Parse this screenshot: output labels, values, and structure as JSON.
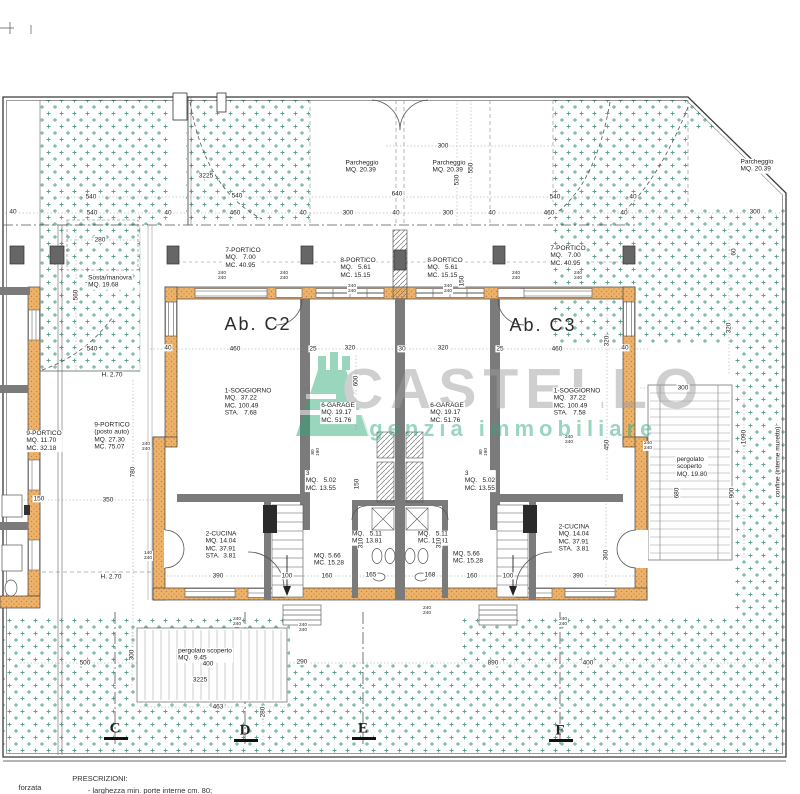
{
  "watermark": {
    "brand": "CASTELLO",
    "tagline": "agenzia immobiliare",
    "brand_color": "#9d9d9d",
    "tagline_color": "#2da879"
  },
  "colors": {
    "stipple_green": "#5aa588",
    "wall_orange": "#edb36b",
    "wall_gray": "#7b7b7b",
    "line_dark": "#3a3a3a"
  },
  "plan": {
    "labels": [
      {
        "n": "room-7-portico-left",
        "k": "room",
        "x": 243,
        "y": 258,
        "t": [
          "7-PORTICO",
          "MQ.   7.00",
          "MC. 40.95"
        ]
      },
      {
        "n": "room-8-portico-left",
        "k": "room",
        "x": 358,
        "y": 268,
        "t": [
          "8-PORTICO",
          "MQ.   5.61",
          "MC. 15.15"
        ]
      },
      {
        "n": "room-8-portico-right",
        "k": "room",
        "x": 445,
        "y": 268,
        "t": [
          "8-PORTICO",
          "MQ.   5.61",
          "MC. 15.15"
        ]
      },
      {
        "n": "room-7-portico-right",
        "k": "room",
        "x": 568,
        "y": 256,
        "t": [
          "7-PORTICO",
          "MQ.   7.00",
          "MC. 40.95"
        ]
      },
      {
        "n": "unit-label-c2",
        "k": "big",
        "x": 258,
        "y": 324,
        "t": [
          "Ab. C2"
        ]
      },
      {
        "n": "unit-label-c3",
        "k": "big",
        "x": 543,
        "y": 325,
        "t": [
          "Ab. C3"
        ]
      },
      {
        "n": "room-soggiorno-left",
        "k": "room",
        "x": 248,
        "y": 402,
        "t": [
          "1-SOGGIORNO",
          "MQ.  37.22",
          "MC. 100.49",
          "STA.   7.68"
        ]
      },
      {
        "n": "room-soggiorno-right",
        "k": "room",
        "x": 577,
        "y": 402,
        "t": [
          "1-SOGGIORNO",
          "MQ.  37.22",
          "MC. 100.49",
          "STA.   7.58"
        ]
      },
      {
        "n": "room-garage-left",
        "k": "room",
        "x": 338,
        "y": 413,
        "t": [
          "6-GARAGE",
          "MQ. 19.17",
          "MC. 51.76"
        ]
      },
      {
        "n": "room-garage-right",
        "k": "room",
        "x": 447,
        "y": 413,
        "t": [
          "6-GARAGE",
          "MQ. 19.17",
          "MC. 51.76"
        ]
      },
      {
        "n": "room-cucina-left",
        "k": "room",
        "x": 221,
        "y": 545,
        "t": [
          "2-CUCINA",
          "MQ. 14.04",
          "MC. 37.91",
          "STA.  3.81"
        ]
      },
      {
        "n": "room-cucina-right",
        "k": "room",
        "x": 574,
        "y": 538,
        "t": [
          "2-CUCINA",
          "MQ. 14.04",
          "MC. 37.91",
          "STA.  3.81"
        ]
      },
      {
        "n": "room-3-left",
        "k": "room",
        "x": 321,
        "y": 481,
        "t": [
          "3",
          "MQ.   5.02",
          "MC. 13.55"
        ]
      },
      {
        "n": "room-3-right",
        "k": "room",
        "x": 480,
        "y": 481,
        "t": [
          "3",
          "MQ.   5.02",
          "MC. 13.55"
        ]
      },
      {
        "n": "room-bath-left",
        "k": "room",
        "x": 367,
        "y": 538,
        "t": [
          "MQ.   5.11",
          "MC. 13.81"
        ]
      },
      {
        "n": "room-bath-right",
        "k": "room",
        "x": 433,
        "y": 538,
        "t": [
          "MQ.   5.11",
          "MC. 13.81"
        ]
      },
      {
        "n": "room-stair-left",
        "k": "room",
        "x": 329,
        "y": 560,
        "t": [
          "MQ. 5.66",
          "MC. 15.28"
        ]
      },
      {
        "n": "room-stair-right",
        "k": "room",
        "x": 468,
        "y": 558,
        "t": [
          "MQ. 5.66",
          "MC. 15.28"
        ]
      },
      {
        "n": "room-9-portico-small",
        "k": "room",
        "x": 44,
        "y": 441,
        "t": [
          "9-PORTICO",
          "MQ. 11.70",
          "MC. 32.18"
        ]
      },
      {
        "n": "room-9-portico-posto",
        "k": "room",
        "x": 112,
        "y": 436,
        "t": [
          "9-PORTICO",
          "(posto auto)",
          "MQ. 27.30",
          "MC. 75.07"
        ]
      },
      {
        "n": "room-sosta-manovra",
        "k": "room",
        "x": 110,
        "y": 282,
        "t": [
          "Sosta/manovra",
          "MQ. 19.68"
        ]
      },
      {
        "n": "room-parcheggio-left",
        "k": "room",
        "x": 362,
        "y": 167,
        "t": [
          "Parcheggio",
          "MQ. 20.39"
        ]
      },
      {
        "n": "room-parcheggio-right",
        "k": "room",
        "x": 449,
        "y": 167,
        "t": [
          "Parcheggio",
          "MQ. 20.39"
        ]
      },
      {
        "n": "room-parcheggio-far",
        "k": "room",
        "x": 757,
        "y": 166,
        "t": [
          "Parcheggio",
          "MQ. 20.39"
        ]
      },
      {
        "n": "room-pergolato-right",
        "k": "room",
        "x": 692,
        "y": 467,
        "t": [
          "pergolato",
          "scoperto",
          "MQ. 19.80"
        ]
      },
      {
        "n": "room-pergolato-bottom",
        "k": "room",
        "x": 205,
        "y": 655,
        "t": [
          "pergolato scoperto",
          "MQ.  9.45"
        ]
      },
      {
        "n": "height-note-1",
        "k": "dim",
        "x": 112,
        "y": 375,
        "t": [
          "H. 2.70"
        ]
      },
      {
        "n": "height-note-2",
        "k": "dim",
        "x": 111,
        "y": 577,
        "t": [
          "H. 2.70"
        ]
      },
      {
        "n": "confine-note",
        "k": "room",
        "r": 1,
        "x": 778,
        "y": 462,
        "t": [
          "confine (interne muretto)"
        ]
      },
      {
        "n": "dim-300-top",
        "x": 443,
        "y": 146,
        "t": [
          "300"
        ]
      },
      {
        "n": "dim-3225-top",
        "x": 206,
        "y": 176,
        "t": [
          "3225"
        ]
      },
      {
        "n": "dim-530",
        "r": 1,
        "x": 457,
        "y": 180,
        "t": [
          "530"
        ]
      },
      {
        "n": "dim-550",
        "r": 1,
        "x": 471,
        "y": 168,
        "t": [
          "550"
        ]
      },
      {
        "n": "dim-540-a",
        "x": 91,
        "y": 197,
        "t": [
          "540"
        ]
      },
      {
        "n": "dim-540-b",
        "x": 237,
        "y": 196,
        "t": [
          "540"
        ]
      },
      {
        "n": "dim-640",
        "x": 397,
        "y": 194,
        "t": [
          "640"
        ]
      },
      {
        "n": "dim-540-c",
        "x": 555,
        "y": 197,
        "t": [
          "540"
        ]
      },
      {
        "n": "dim-40-a",
        "x": 633,
        "y": 197,
        "t": [
          "40"
        ]
      },
      {
        "n": "dim-40-b",
        "x": 13,
        "y": 212,
        "t": [
          "40"
        ]
      },
      {
        "n": "dim-540-d",
        "x": 92,
        "y": 213,
        "t": [
          "540"
        ]
      },
      {
        "n": "dim-40-c",
        "x": 168,
        "y": 213,
        "t": [
          "40"
        ]
      },
      {
        "n": "dim-460-a",
        "x": 235,
        "y": 213,
        "t": [
          "460"
        ]
      },
      {
        "n": "dim-40-d",
        "x": 303,
        "y": 213,
        "t": [
          "40"
        ]
      },
      {
        "n": "dim-300-a",
        "x": 348,
        "y": 213,
        "t": [
          "300"
        ]
      },
      {
        "n": "dim-40-e",
        "x": 396,
        "y": 213,
        "t": [
          "40"
        ]
      },
      {
        "n": "dim-300-b",
        "x": 448,
        "y": 213,
        "t": [
          "300"
        ]
      },
      {
        "n": "dim-40-f",
        "x": 492,
        "y": 213,
        "t": [
          "40"
        ]
      },
      {
        "n": "dim-460-b",
        "x": 549,
        "y": 213,
        "t": [
          "460"
        ]
      },
      {
        "n": "dim-40-g",
        "x": 624,
        "y": 213,
        "t": [
          "40"
        ]
      },
      {
        "n": "dim-300-c",
        "x": 755,
        "y": 212,
        "t": [
          "300"
        ]
      },
      {
        "n": "dim-280",
        "x": 100,
        "y": 240,
        "t": [
          "280"
        ]
      },
      {
        "n": "dim-60",
        "r": 1,
        "x": 734,
        "y": 252,
        "t": [
          "60"
        ]
      },
      {
        "n": "dim-150-a",
        "r": 1,
        "x": 462,
        "y": 281,
        "t": [
          "150"
        ]
      },
      {
        "n": "dim-560",
        "r": 1,
        "x": 76,
        "y": 295,
        "t": [
          "560"
        ]
      },
      {
        "n": "dim-320-r",
        "r": 1,
        "x": 729,
        "y": 328,
        "t": [
          "320"
        ]
      },
      {
        "n": "dim-540-e",
        "x": 92,
        "y": 349,
        "t": [
          "540"
        ]
      },
      {
        "n": "dim-40-h",
        "x": 168,
        "y": 348,
        "t": [
          "40"
        ]
      },
      {
        "n": "dim-460-c",
        "x": 235,
        "y": 349,
        "t": [
          "460"
        ]
      },
      {
        "n": "dim-25-a",
        "x": 313,
        "y": 349,
        "t": [
          "25"
        ]
      },
      {
        "n": "dim-320-a",
        "x": 350,
        "y": 348,
        "t": [
          "320"
        ]
      },
      {
        "n": "dim-30",
        "x": 402,
        "y": 349,
        "t": [
          "30"
        ]
      },
      {
        "n": "dim-320-b",
        "x": 443,
        "y": 348,
        "t": [
          "320"
        ]
      },
      {
        "n": "dim-25-b",
        "x": 500,
        "y": 349,
        "t": [
          "25"
        ]
      },
      {
        "n": "dim-460-d",
        "x": 557,
        "y": 349,
        "t": [
          "460"
        ]
      },
      {
        "n": "dim-40-i",
        "x": 625,
        "y": 348,
        "t": [
          "40"
        ]
      },
      {
        "n": "dim-600",
        "r": 1,
        "x": 356,
        "y": 381,
        "t": [
          "600"
        ]
      },
      {
        "n": "dim-320-c",
        "r": 1,
        "x": 607,
        "y": 341,
        "t": [
          "320"
        ]
      },
      {
        "n": "dim-300-d",
        "x": 683,
        "y": 388,
        "t": [
          "300"
        ]
      },
      {
        "n": "dim-1090",
        "r": 1,
        "x": 744,
        "y": 437,
        "t": [
          "1090"
        ]
      },
      {
        "n": "dim-450",
        "r": 1,
        "x": 607,
        "y": 445,
        "t": [
          "450"
        ]
      },
      {
        "n": "dim-780",
        "r": 1,
        "x": 133,
        "y": 472,
        "t": [
          "780"
        ]
      },
      {
        "n": "dim-150-b",
        "r": 1,
        "x": 357,
        "y": 484,
        "t": [
          "150"
        ]
      },
      {
        "n": "dim-680",
        "r": 1,
        "x": 677,
        "y": 493,
        "t": [
          "680"
        ]
      },
      {
        "n": "dim-900",
        "r": 1,
        "x": 732,
        "y": 493,
        "t": [
          "900"
        ]
      },
      {
        "n": "dim-150-c",
        "x": 39,
        "y": 499,
        "t": [
          "150"
        ]
      },
      {
        "n": "dim-350",
        "x": 108,
        "y": 500,
        "t": [
          "350"
        ]
      },
      {
        "n": "dim-310-a",
        "r": 1,
        "x": 361,
        "y": 543,
        "t": [
          "310"
        ]
      },
      {
        "n": "dim-310-b",
        "r": 1,
        "x": 439,
        "y": 543,
        "t": [
          "310"
        ]
      },
      {
        "n": "dim-360",
        "r": 1,
        "x": 606,
        "y": 555,
        "t": [
          "360"
        ]
      },
      {
        "n": "dim-390-a",
        "x": 218,
        "y": 576,
        "t": [
          "390"
        ]
      },
      {
        "n": "dim-100-a",
        "x": 287,
        "y": 576,
        "t": [
          "100"
        ]
      },
      {
        "n": "dim-160-a",
        "x": 327,
        "y": 576,
        "t": [
          "160"
        ]
      },
      {
        "n": "dim-165",
        "x": 371,
        "y": 575,
        "t": [
          "165"
        ]
      },
      {
        "n": "dim-168",
        "x": 430,
        "y": 575,
        "t": [
          "168"
        ]
      },
      {
        "n": "dim-160-b",
        "x": 472,
        "y": 576,
        "t": [
          "160"
        ]
      },
      {
        "n": "dim-100-b",
        "x": 508,
        "y": 576,
        "t": [
          "100"
        ]
      },
      {
        "n": "dim-390-b",
        "x": 578,
        "y": 576,
        "t": [
          "390"
        ]
      },
      {
        "n": "dim-300-e",
        "r": 1,
        "x": 132,
        "y": 655,
        "t": [
          "300"
        ]
      },
      {
        "n": "dim-500",
        "x": 85,
        "y": 663,
        "t": [
          "500"
        ]
      },
      {
        "n": "dim-400-a",
        "x": 208,
        "y": 664,
        "t": [
          "400"
        ]
      },
      {
        "n": "dim-290",
        "x": 302,
        "y": 662,
        "t": [
          "290"
        ]
      },
      {
        "n": "dim-890",
        "x": 493,
        "y": 663,
        "t": [
          "890"
        ]
      },
      {
        "n": "dim-400-b",
        "x": 588,
        "y": 663,
        "t": [
          "400"
        ]
      },
      {
        "n": "dim-3225-bottom",
        "x": 200,
        "y": 680,
        "t": [
          "3225"
        ]
      },
      {
        "n": "dim-463",
        "x": 218,
        "y": 707,
        "t": [
          "463"
        ]
      },
      {
        "n": "dim-280-v",
        "r": 1,
        "x": 263,
        "y": 712,
        "t": [
          "280"
        ]
      },
      {
        "n": "pair-window-a",
        "k": "pair",
        "x": 222,
        "y": 276,
        "t": [
          "240",
          "240"
        ]
      },
      {
        "n": "pair-window-b",
        "k": "pair",
        "x": 284,
        "y": 276,
        "t": [
          "240",
          "240"
        ]
      },
      {
        "n": "pair-window-c",
        "k": "pair",
        "x": 516,
        "y": 276,
        "t": [
          "240",
          "240"
        ]
      },
      {
        "n": "pair-window-d",
        "k": "pair",
        "x": 578,
        "y": 276,
        "t": [
          "240",
          "240"
        ]
      },
      {
        "n": "pair-garage-a",
        "k": "pair",
        "x": 352,
        "y": 289,
        "t": [
          "240",
          "240"
        ]
      },
      {
        "n": "pair-garage-b",
        "k": "pair",
        "x": 448,
        "y": 289,
        "t": [
          "240",
          "240"
        ]
      },
      {
        "n": "pair-window-e",
        "k": "pair",
        "x": 146,
        "y": 447,
        "t": [
          "240",
          "240"
        ]
      },
      {
        "n": "pair-window-f",
        "k": "pair",
        "x": 569,
        "y": 440,
        "t": [
          "240",
          "240"
        ]
      },
      {
        "n": "pair-window-g",
        "k": "pair",
        "x": 648,
        "y": 446,
        "t": [
          "240",
          "240"
        ]
      },
      {
        "n": "pair-window-h",
        "k": "pair",
        "x": 148,
        "y": 556,
        "t": [
          "140",
          "240"
        ]
      },
      {
        "n": "pair-door-a",
        "k": "pair",
        "r": 1,
        "x": 316,
        "y": 452,
        "t": [
          "80",
          "190"
        ]
      },
      {
        "n": "pair-door-b",
        "k": "pair",
        "r": 1,
        "x": 484,
        "y": 452,
        "t": [
          "80",
          "190"
        ]
      },
      {
        "n": "pair-window-i",
        "k": "pair",
        "x": 237,
        "y": 622,
        "t": [
          "240",
          "240"
        ]
      },
      {
        "n": "pair-window-j",
        "k": "pair",
        "x": 303,
        "y": 628,
        "t": [
          "240",
          "240"
        ]
      },
      {
        "n": "pair-window-k",
        "k": "pair",
        "x": 427,
        "y": 611,
        "t": [
          "240",
          "240"
        ]
      },
      {
        "n": "pair-window-l",
        "k": "pair",
        "x": 563,
        "y": 622,
        "t": [
          "240",
          "240"
        ]
      },
      {
        "n": "grid-letter-c",
        "k": "grid",
        "x": 115,
        "y": 729,
        "t": [
          "C"
        ]
      },
      {
        "n": "grid-letter-d",
        "k": "grid",
        "x": 245,
        "y": 731,
        "t": [
          "D"
        ]
      },
      {
        "n": "grid-letter-e",
        "k": "grid",
        "x": 363,
        "y": 729,
        "t": [
          "E"
        ]
      },
      {
        "n": "grid-letter-f",
        "k": "grid",
        "x": 560,
        "y": 731,
        "t": [
          "F"
        ]
      },
      {
        "n": "note-forzata",
        "k": "note",
        "x": 30,
        "y": 788,
        "t": [
          "forzata"
        ]
      },
      {
        "n": "note-prescrizioni",
        "k": "note",
        "x": 100,
        "y": 779,
        "t": [
          "PRESCRIZIONI:"
        ]
      },
      {
        "n": "note-larghezza",
        "k": "note",
        "x": 150,
        "y": 791,
        "t": [
          "- larghezza min. porte interne cm. 80;"
        ]
      }
    ]
  }
}
